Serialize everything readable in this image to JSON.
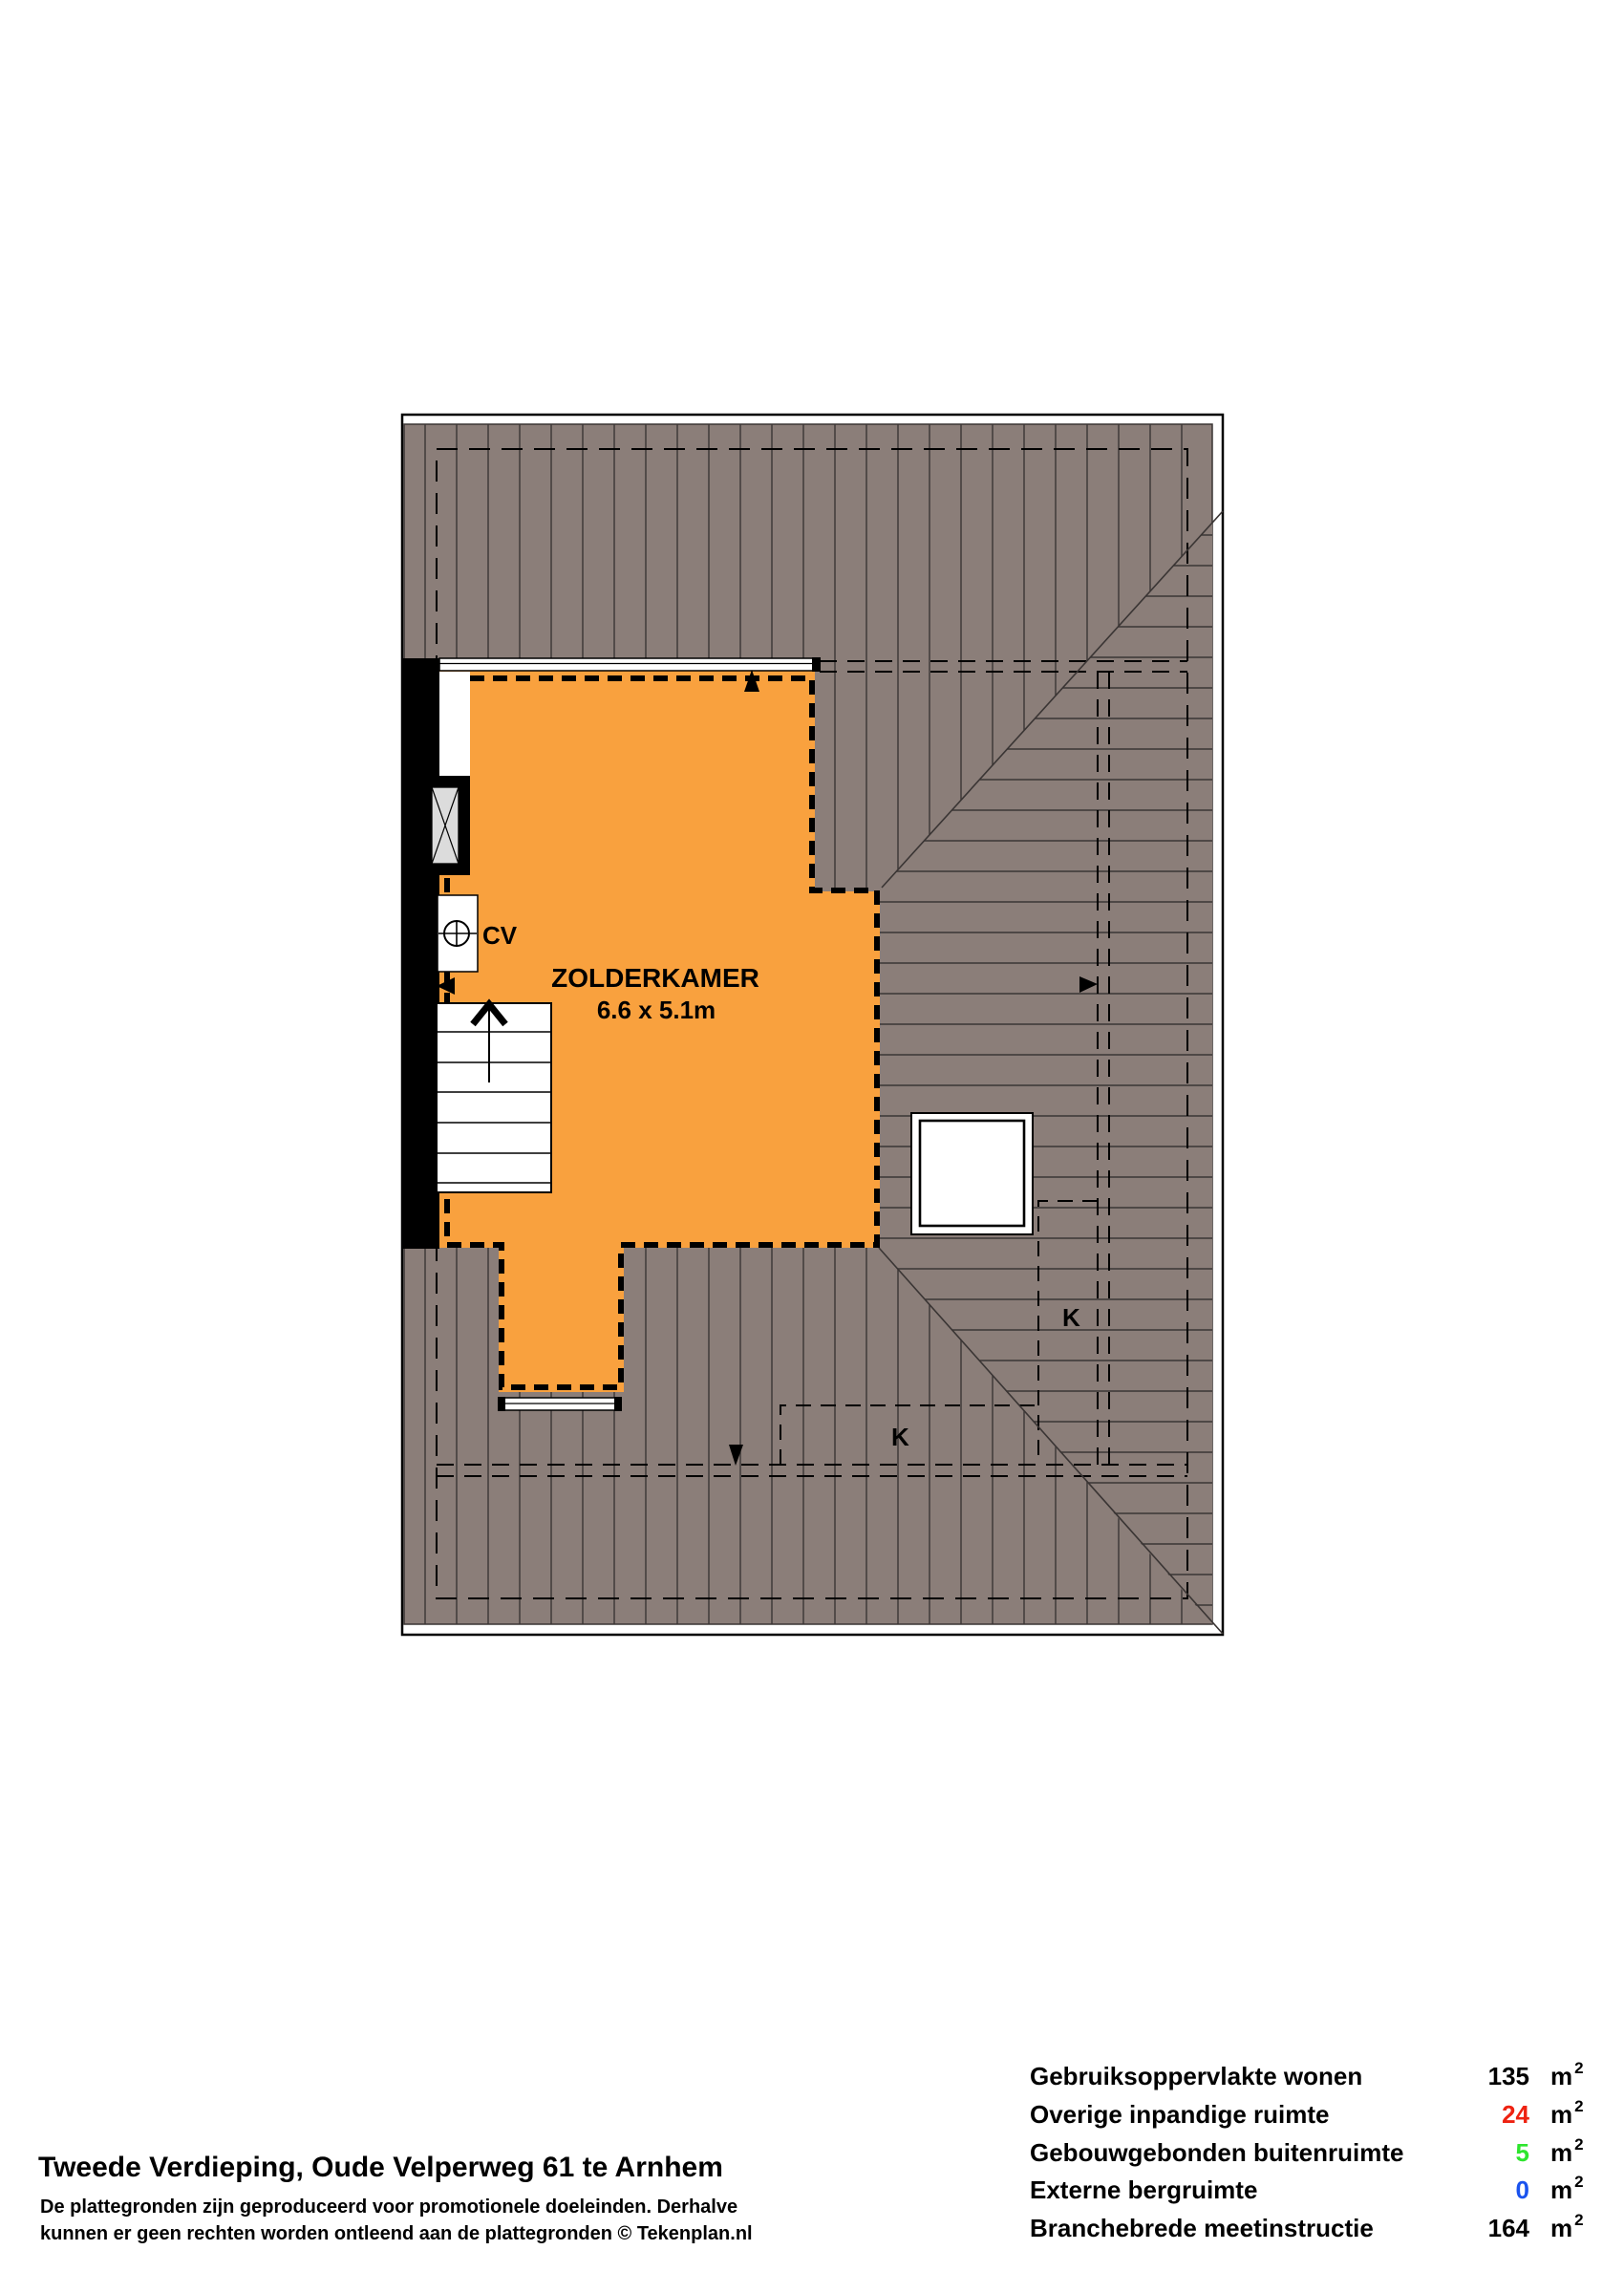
{
  "floorplan": {
    "room_label": "ZOLDERKAMER",
    "room_dimensions": "6.6 x 5.1m",
    "cv_label": "CV",
    "skylight_label_right": "K",
    "skylight_label_bottom": "K",
    "colors": {
      "roof_fill": "#8B7E79",
      "hatch_line": "#3A3534",
      "room_fill": "#F9A13E",
      "boundary": "#000000",
      "window_pane": "#DCDCDC"
    }
  },
  "footer": {
    "title": "Tweede Verdieping, Oude Velperweg 61 te Arnhem",
    "disclaimer_line1": "De plattegronden zijn geproduceerd voor promotionele doeleinden. Derhalve",
    "disclaimer_line2": "kunnen er geen rechten worden ontleend aan de plattegronden © Tekenplan.nl"
  },
  "summary": {
    "rows": [
      {
        "label": "Gebruiksoppervlakte wonen",
        "value": "135",
        "unit": "m",
        "sup": "2",
        "color": "#000000"
      },
      {
        "label": "Overige inpandige ruimte",
        "value": "24",
        "unit": "m",
        "sup": "2",
        "color": "#EE2211"
      },
      {
        "label": "Gebouwgebonden buitenruimte",
        "value": "5",
        "unit": "m",
        "sup": "2",
        "color": "#2EE52E"
      },
      {
        "label": "Externe bergruimte",
        "value": "0",
        "unit": "m",
        "sup": "2",
        "color": "#1A53EE"
      },
      {
        "label": "Branchebrede meetinstructie",
        "value": "164",
        "unit": "m",
        "sup": "2",
        "color": "#000000"
      }
    ]
  }
}
